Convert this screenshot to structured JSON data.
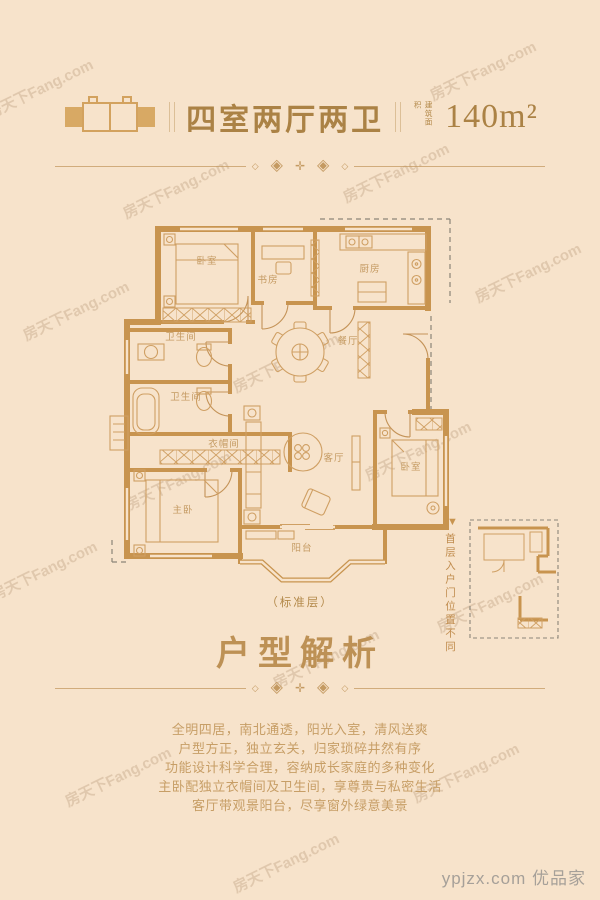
{
  "header": {
    "title": "四室两厅两卫",
    "area_label": "建筑面积",
    "area_value": "140m²"
  },
  "divider": {
    "ornaments": [
      "◇",
      "◈",
      "✛",
      "◈",
      "◇"
    ]
  },
  "floorplan": {
    "rooms": {
      "bedroom_top": "卧室",
      "study": "书房",
      "kitchen": "厨房",
      "bath1": "卫生间",
      "bath2": "卫生间",
      "cloakroom": "衣帽间",
      "master": "主卧",
      "dining": "餐厅",
      "living": "客厅",
      "bedroom_right": "卧室",
      "balcony": "阳台"
    },
    "floor_note": "（标准层）",
    "inset_arrow": "▼",
    "inset_note": "首层入户门位置不同"
  },
  "analysis": {
    "title": "户型解析",
    "lines": [
      "全明四居，南北通透，阳光入室，清风送爽",
      "户型方正，独立玄关，归家琐碎井然有序",
      "功能设计科学合理，容纳成长家庭的多种变化",
      "主卧配独立衣帽间及卫生间，享尊贵与私密生活",
      "客厅带观景阳台，尽享窗外绿意美景"
    ]
  },
  "watermark": {
    "text": "房天下Fang.com"
  },
  "footer": {
    "credit": "ypjzx.com 优品家"
  },
  "colors": {
    "background": "#f7e3cb",
    "wall": "#c8944f",
    "furniture_line": "#cf9f63",
    "gold_text": "#ab8245",
    "paragraph_text": "#c79e66",
    "dash_gray": "#8b8578",
    "credit_gray": "#a6a099"
  }
}
